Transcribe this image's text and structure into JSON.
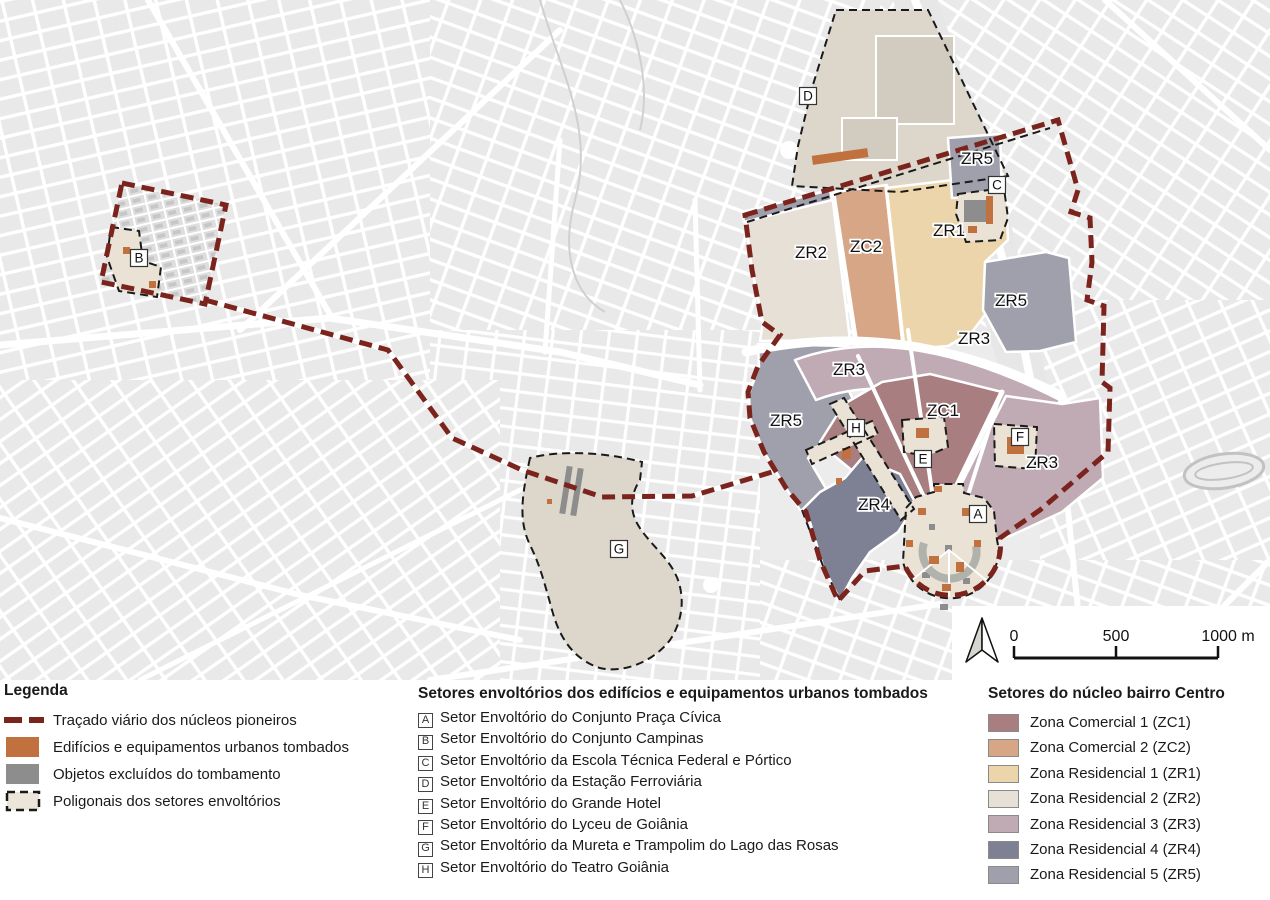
{
  "map": {
    "zone_labels": [
      "ZR2",
      "ZC2",
      "ZR1",
      "ZR5",
      "ZR5",
      "ZR3",
      "ZR3",
      "ZC1",
      "ZR5",
      "ZR3",
      "ZR4"
    ],
    "sector_letters": [
      "A",
      "B",
      "C",
      "D",
      "E",
      "F",
      "G",
      "H"
    ],
    "scale_bar": {
      "tick_0": "0",
      "tick_500": "500",
      "tick_1000": "1000 m"
    }
  },
  "legend": {
    "title": "Legenda",
    "items": [
      {
        "label": "Traçado viário dos núcleos pioneiros",
        "color": "#7b241d",
        "style": "dashed-line"
      },
      {
        "label": "Edifícios e equipamentos urbanos tombados",
        "color": "#c0713d",
        "style": "fill"
      },
      {
        "label": "Objetos excluídos do tombamento",
        "color": "#8d8d8d",
        "style": "fill"
      },
      {
        "label": "Poligonais dos setores envoltórios",
        "color": "#ece6da",
        "outline_color": "#1a1a1a",
        "style": "dashed-outline"
      }
    ]
  },
  "sectors_legend": {
    "title": "Setores envoltórios dos edifícios e equipamentos urbanos tombados",
    "items": [
      {
        "letter": "A",
        "label": "Setor Envoltório do Conjunto Praça Cívica"
      },
      {
        "letter": "B",
        "label": "Setor Envoltório do Conjunto Campinas"
      },
      {
        "letter": "C",
        "label": "Setor Envoltório da Escola Técnica Federal e Pórtico"
      },
      {
        "letter": "D",
        "label": "Setor Envoltório da Estação Ferroviária"
      },
      {
        "letter": "E",
        "label": "Setor Envoltório do Grande Hotel"
      },
      {
        "letter": "F",
        "label": "Setor Envoltório do Lyceu de Goiânia"
      },
      {
        "letter": "G",
        "label": "Setor Envoltório da Mureta e Trampolim do Lago das Rosas"
      },
      {
        "letter": "H",
        "label": "Setor Envoltório do Teatro Goiânia"
      }
    ]
  },
  "zones_legend": {
    "title": "Setores do núcleo bairro Centro",
    "items": [
      {
        "label": "Zona Comercial 1 (ZC1)",
        "color": "#a87e80"
      },
      {
        "label": "Zona Comercial 2 (ZC2)",
        "color": "#d6a687"
      },
      {
        "label": "Zona Residencial 1 (ZR1)",
        "color": "#ecd5ab"
      },
      {
        "label": "Zona Residencial 2 (ZR2)",
        "color": "#e6e0d7"
      },
      {
        "label": "Zona Residencial 3 (ZR3)",
        "color": "#c0abb5"
      },
      {
        "label": "Zona Residencial 4 (ZR4)",
        "color": "#7e8094"
      },
      {
        "label": "Zona Residencial 5 (ZR5)",
        "color": "#9fa0ac"
      }
    ]
  }
}
